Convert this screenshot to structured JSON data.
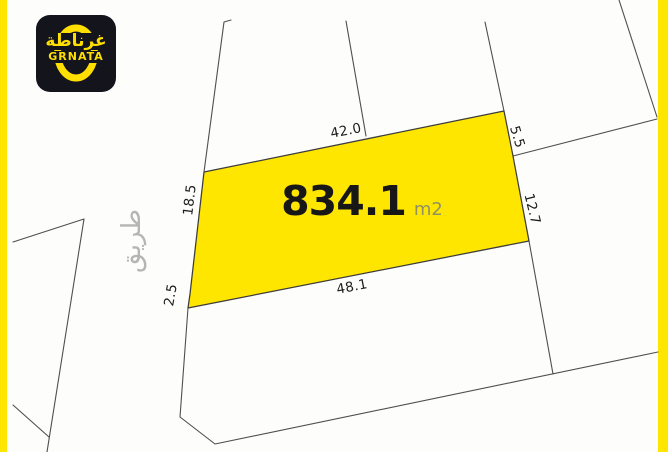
{
  "brand": {
    "logo_arabic": "غرناطة",
    "logo_latin": "GRNATA"
  },
  "parcel": {
    "area_value": "834.1",
    "area_unit": "m2",
    "dimensions": {
      "top": "42.0",
      "left": "18.5",
      "top_right": "5.5",
      "right": "12.7",
      "bottom_left": "2.5",
      "bottom": "48.1"
    }
  },
  "labels": {
    "road_arabic": "طريق"
  },
  "colors": {
    "highlight_yellow": "#ffe600",
    "boundary_gray": "#4f4f4f",
    "logo_background": "#14141c",
    "logo_yellow": "#ffdf00",
    "muted_gray": "#b5b5b5",
    "area_text": "#171717",
    "unit_olive": "#8f9063"
  }
}
